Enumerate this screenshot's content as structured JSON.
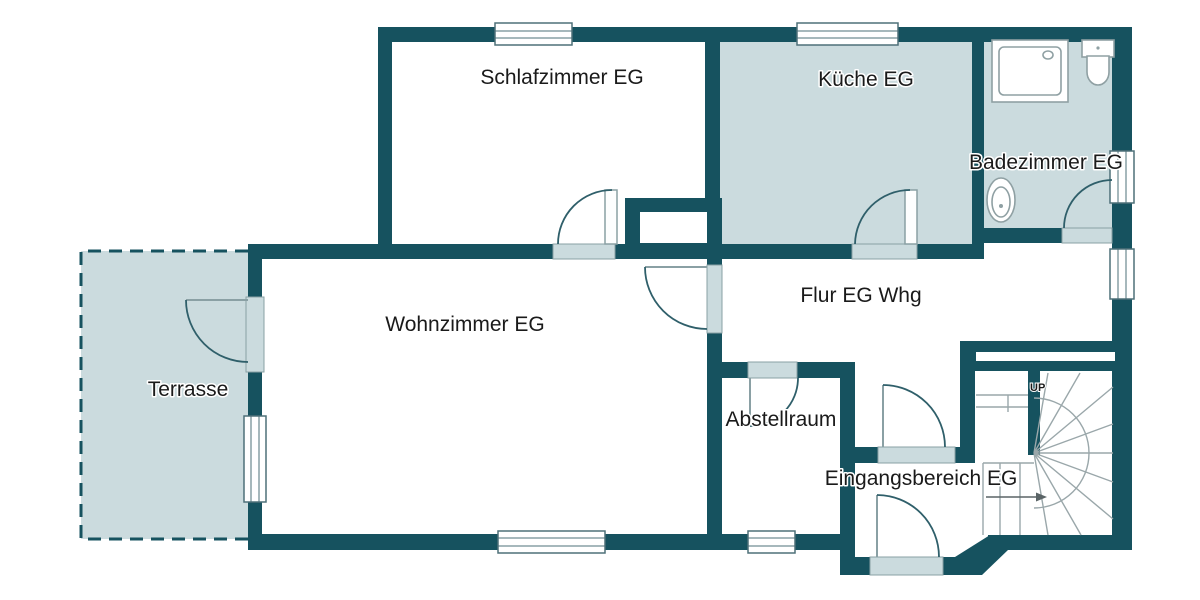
{
  "plan": {
    "rooms": [
      {
        "id": "schlafzimmer",
        "label": "Schlafzimmer EG"
      },
      {
        "id": "kueche",
        "label": "Küche EG"
      },
      {
        "id": "badezimmer",
        "label": "Badezimmer EG"
      },
      {
        "id": "flur",
        "label": "Flur EG Whg"
      },
      {
        "id": "wohnzimmer",
        "label": "Wohnzimmer EG"
      },
      {
        "id": "terrasse",
        "label": "Terrasse"
      },
      {
        "id": "abstellraum",
        "label": "Abstellraum"
      },
      {
        "id": "eingangsbereich",
        "label": "Eingangsbereich EG"
      }
    ],
    "stairs": {
      "up_label": "UP"
    },
    "colors": {
      "background": "#ffffff",
      "wall": "#16525f",
      "room_fill": "#cbdbde",
      "window_frame": "#4e7079",
      "sill_border": "#8aa0a4",
      "door_arc": "#2f5f6a",
      "fixture_line": "#8fa0a3",
      "stair_line": "#9aa7aa",
      "arrow": "#5a6466",
      "text": "#1a1a1a"
    }
  }
}
